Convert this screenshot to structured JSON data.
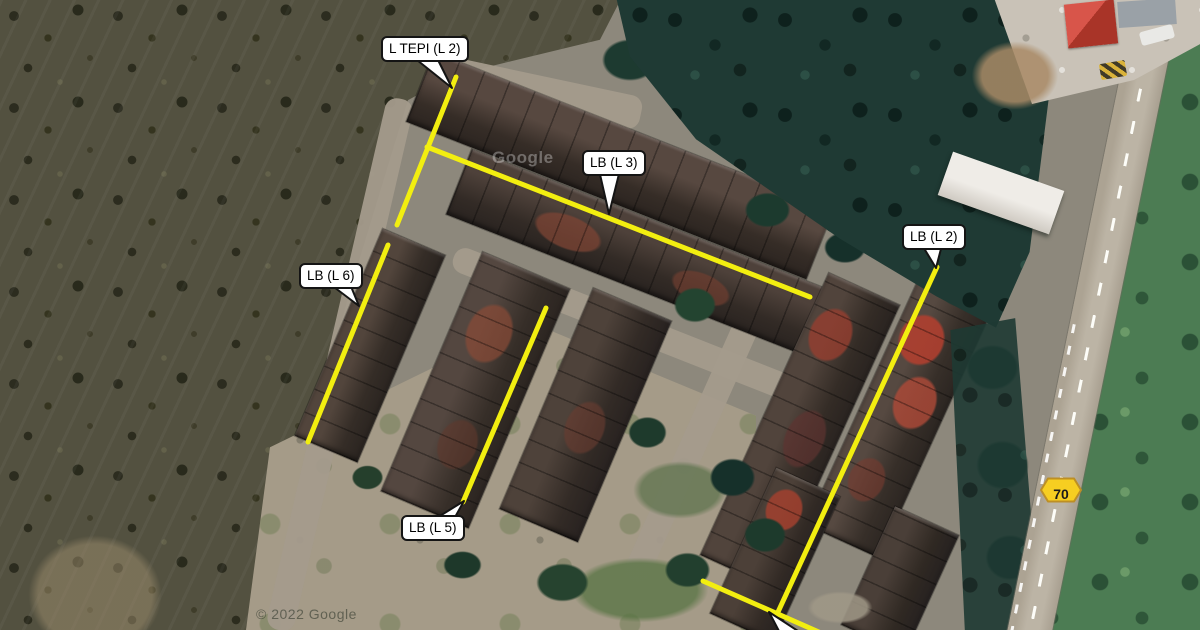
{
  "map": {
    "description": "Satellite view of a terraced housing estate beside an oil palm plantation with yellow survey overlay lines",
    "provider_watermark": "Google",
    "copyright_watermark": "© 2022 Google",
    "route_shield": {
      "label": "70",
      "fill": "#f6ce21",
      "border": "#bd8f25"
    },
    "annotations": {
      "line_color": "#f2ee10",
      "line_width": 5,
      "callouts": [
        {
          "id": "l-tepi-l2",
          "label": "L TEPI (L 2)",
          "line": [
            456,
            77,
            397,
            225
          ],
          "tail": [
            [
              412,
              56
            ],
            [
              436,
              56
            ],
            [
              452,
              88
            ]
          ]
        },
        {
          "id": "lb-l3",
          "label": "LB (L 3)",
          "line": [
            427,
            147,
            810,
            297
          ],
          "tail": [
            [
              599,
              170
            ],
            [
              620,
              170
            ],
            [
              609,
              214
            ]
          ]
        },
        {
          "id": "lb-l6",
          "label": "LB (L 6)",
          "line": [
            388,
            245,
            308,
            442
          ],
          "tail": [
            [
              330,
              284
            ],
            [
              350,
              284
            ],
            [
              359,
              306
            ]
          ]
        },
        {
          "id": "lb-l2",
          "label": "LB (L 2)",
          "line": [
            937,
            267,
            778,
            612
          ],
          "tail": [
            [
              922,
              245
            ],
            [
              942,
              245
            ],
            [
              936,
              268
            ]
          ]
        },
        {
          "id": "lb-l5",
          "label": "LB (L 5)",
          "line": [
            546,
            308,
            463,
            502
          ],
          "tail": [
            [
              435,
              519
            ],
            [
              454,
              519
            ],
            [
              464,
              501
            ]
          ]
        }
      ],
      "unlabeled_lines": [
        [
          703,
          581,
          821,
          633
        ]
      ],
      "clipped_tail": [
        [
          769,
          612
        ],
        [
          780,
          633
        ],
        [
          801,
          633
        ]
      ]
    }
  }
}
